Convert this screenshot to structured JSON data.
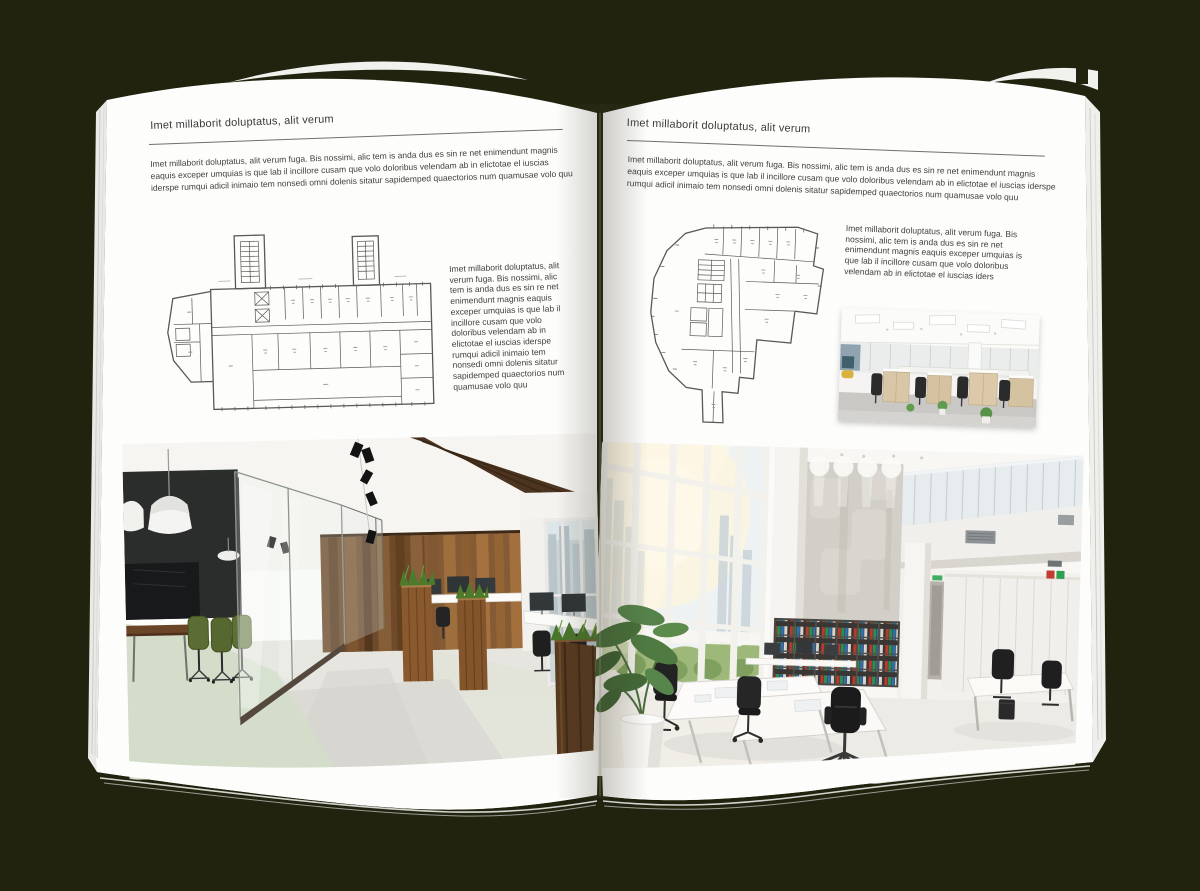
{
  "scene": {
    "background_color": "#21230f",
    "paper_color": "#fdfdfc"
  },
  "left_page": {
    "header": "Imet millaborit doluptatus, alit verum",
    "intro": "Imet millaborit doluptatus, alit verum fuga. Bis nossimi, alic tem is anda dus es sin re net enimendunt magnis eaquis exceper umquias is que lab il incillore cusam que volo doloribus velendam ab in elictotae el iuscias iderspe rumqui adicil inimaio tem nonsedi omni dolenis sitatur sapidemped quaectorios num quamusae volo quu",
    "sidebar_text": "Imet millaborit doluptatus, alit verum fuga. Bis nossimi, alic tem is anda dus es sin re net enimendunt magnis eaquis exceper umquias is que lab il incillore cusam que volo doloribus velendam ab in elictotae el iuscias iderspe rumqui adicil inimaio tem nonsedi omni dolenis sitatur sapidemped quaectorios num quamusae volo quu",
    "figures": {
      "floor_plan": "architectural-floor-plan-slab-building",
      "photo": "office-interior-wood-panels-glass-meeting-room"
    }
  },
  "right_page": {
    "header": "Imet millaborit doluptatus, alit verum",
    "intro": "Imet millaborit doluptatus, alit verum fuga. Bis nossimi, alic tem is anda dus es sin re net enimendunt magnis eaquis exceper umquias is que lab il incillore cusam que volo doloribus velendam ab in elictotae el iuscias iderspe rumqui adicil inimaio tem nonsedi omni dolenis sitatur sapidemped quaectorios num quamusae volo quu",
    "caption_text": "Imet millaborit doluptatus, alit verum fuga. Bis nossimi, alic tem is anda dus es sin re net enimendunt magnis eaquis exceper umquias is que lab il incillore cusam que volo doloribus velendam ab in elictotae el iuscias iders",
    "figures": {
      "floor_plan": "architectural-floor-plan-irregular-building",
      "photo_small": "open-plan-office-desks-photo",
      "photo_large": "white-double-height-office-photo"
    }
  }
}
